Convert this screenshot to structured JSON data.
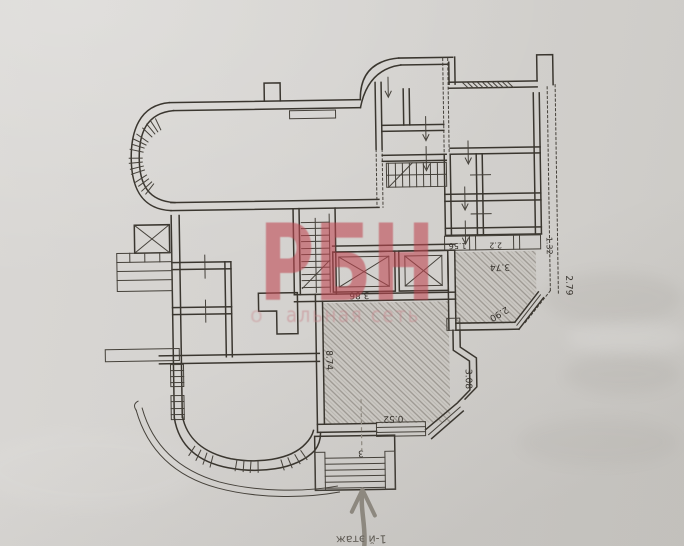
{
  "photo": {
    "kind": "scanned floor plan photo (plan printed upside-down)",
    "paper_color": "#d4d2cf",
    "ink_color": "#3a362f"
  },
  "watermark": {
    "title": "РБН",
    "subtitle_prefix": "о",
    "subtitle": "альная сеть",
    "color": "#bf4750"
  },
  "plan": {
    "floor_note": "1-й этаж",
    "dims": {
      "elevator_bay": "3.86",
      "hall_width": "8.74",
      "threshold": "0.52",
      "porch_steps": "3",
      "strip_a": "1.56",
      "strip_b": "2.2",
      "strip_c": "1.32",
      "room_width": "3.74",
      "corner_diag": "2.90",
      "side_depth": "2.79",
      "bay_depth": "3.08"
    }
  }
}
